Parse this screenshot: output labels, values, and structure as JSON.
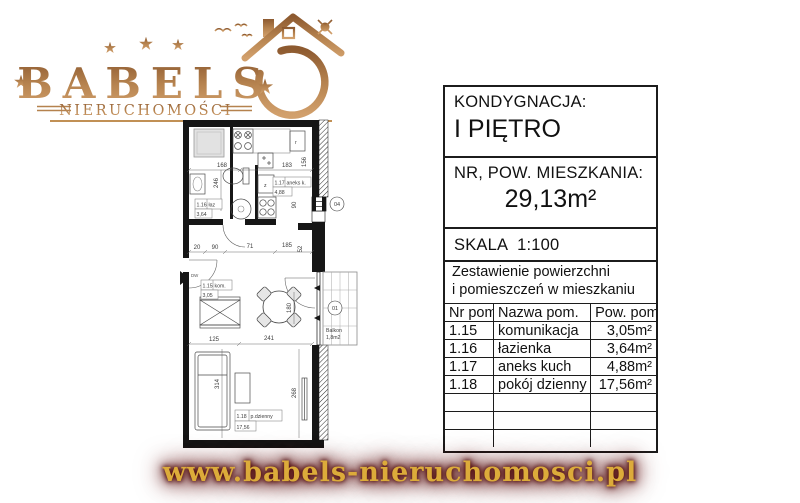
{
  "logo": {
    "brand": "BABELS",
    "subtitle": "NIERUCHOMOŚCI"
  },
  "footer": {
    "url": "www.babels-nieruchomosci.pl"
  },
  "panel": {
    "kondygnacja_label": "KONDYGNACJA:",
    "kondygnacja_value": "I PIĘTRO",
    "nr_pow_label": "NR, POW. MIESZKANIA:",
    "nr_pow_value": "29,13m²",
    "skala_label": "SKALA",
    "skala_value": "1:100",
    "zestawienie_line1": "Zestawienie powierzchni",
    "zestawienie_line2": "i pomieszczeń w mieszkaniu",
    "table": {
      "headers": [
        "Nr pom.",
        "Nazwa pom.",
        "Pow. pom."
      ],
      "rows": [
        {
          "nr": "1.15",
          "name": "komunikacja",
          "area": "3,05m²"
        },
        {
          "nr": "1.16",
          "name": "łazienka",
          "area": "3,64m²"
        },
        {
          "nr": "1.17",
          "name": "aneks kuch",
          "area": "4,88m²"
        },
        {
          "nr": "1.18",
          "name": "pokój dzienny",
          "area": "17,56m²"
        }
      ]
    }
  },
  "plan": {
    "rooms": [
      {
        "nr": "1.15",
        "short": "kom.",
        "area": "3,05"
      },
      {
        "nr": "1.16",
        "short": "łaz",
        "area": "3,64"
      },
      {
        "nr": "1.17",
        "short": "aneks k.",
        "area": "4,88"
      },
      {
        "nr": "1.18",
        "short": "p.dzienny",
        "area": "17,56"
      }
    ],
    "balcony": {
      "name": "Balkon",
      "area": "1,8m2"
    },
    "markers": {
      "window": "04",
      "door": "01",
      "entry": "DW"
    },
    "symbols": {
      "fridge": "г",
      "appliance": "z"
    },
    "dims": [
      "168",
      "246",
      "183",
      "156",
      "90",
      "20",
      "90",
      "71",
      "185",
      "52",
      "125",
      "241",
      "180",
      "314",
      "268"
    ]
  },
  "colors": {
    "copper": "#b5824e",
    "gold": "#dcab3a",
    "glow": "#4b0606",
    "line": "#161616"
  }
}
